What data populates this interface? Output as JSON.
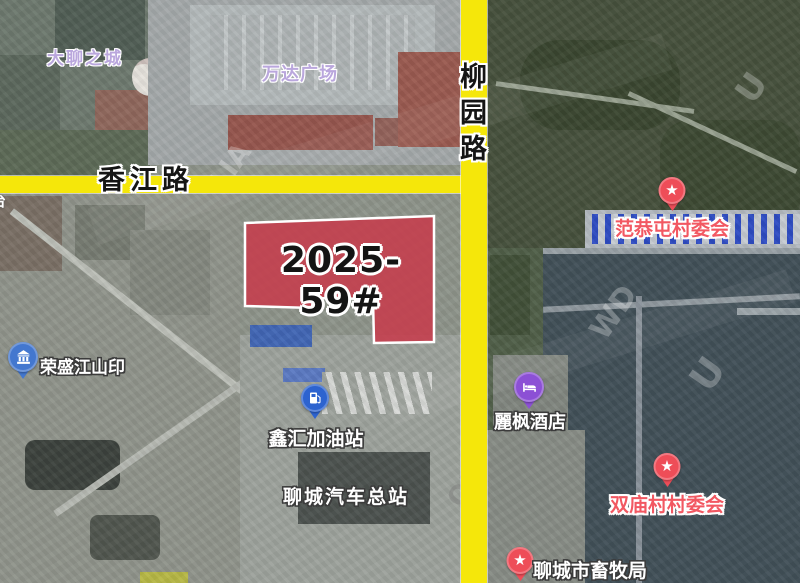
{
  "map": {
    "roads": {
      "horizontal": {
        "name": "香江路"
      },
      "vertical": {
        "name": "柳园路"
      },
      "color": "#f5e70a",
      "edge_label_partial": "台"
    },
    "parcel": {
      "label": "2025-59#",
      "fill": "#c63c4c",
      "stroke": "#ffffff"
    },
    "pois": [
      {
        "label": "大聊之城",
        "type": "area",
        "label_color": "#baa7dd"
      },
      {
        "label": "万达广场",
        "type": "area",
        "label_color": "#baa7dd"
      },
      {
        "label": "范恭屯村委会",
        "type": "village-committee",
        "pin": "star-pin",
        "pin_color": "#ee4d58",
        "label_color": "#f25862"
      },
      {
        "label": "荣盛江山印",
        "type": "residence",
        "pin": "bank-pin",
        "pin_color": "#4377cf",
        "label_color": "#ffffff"
      },
      {
        "label": "鑫汇加油站",
        "type": "gas-station",
        "pin": "gas-pin",
        "pin_color": "#2d63cf",
        "label_color": "#ffffff"
      },
      {
        "label": "麗枫酒店",
        "type": "hotel",
        "pin": "hotel-pin",
        "pin_color": "#8c50d5",
        "label_color": "#ffffff"
      },
      {
        "label": "聊城汽车总站",
        "type": "bus-station",
        "pin": null,
        "label_color": "#ffffff"
      },
      {
        "label": "双庙村村委会",
        "type": "village-committee",
        "pin": "star-pin",
        "pin_color": "#ee4d58",
        "label_color": "#f25862"
      },
      {
        "label": "聊城市畜牧局",
        "type": "government",
        "pin": "star-pin",
        "pin_color": "#ee4d58",
        "label_color": "#ffffff"
      }
    ],
    "watermark_fragments": [
      "LIA",
      "WD",
      "OR",
      "U"
    ]
  }
}
